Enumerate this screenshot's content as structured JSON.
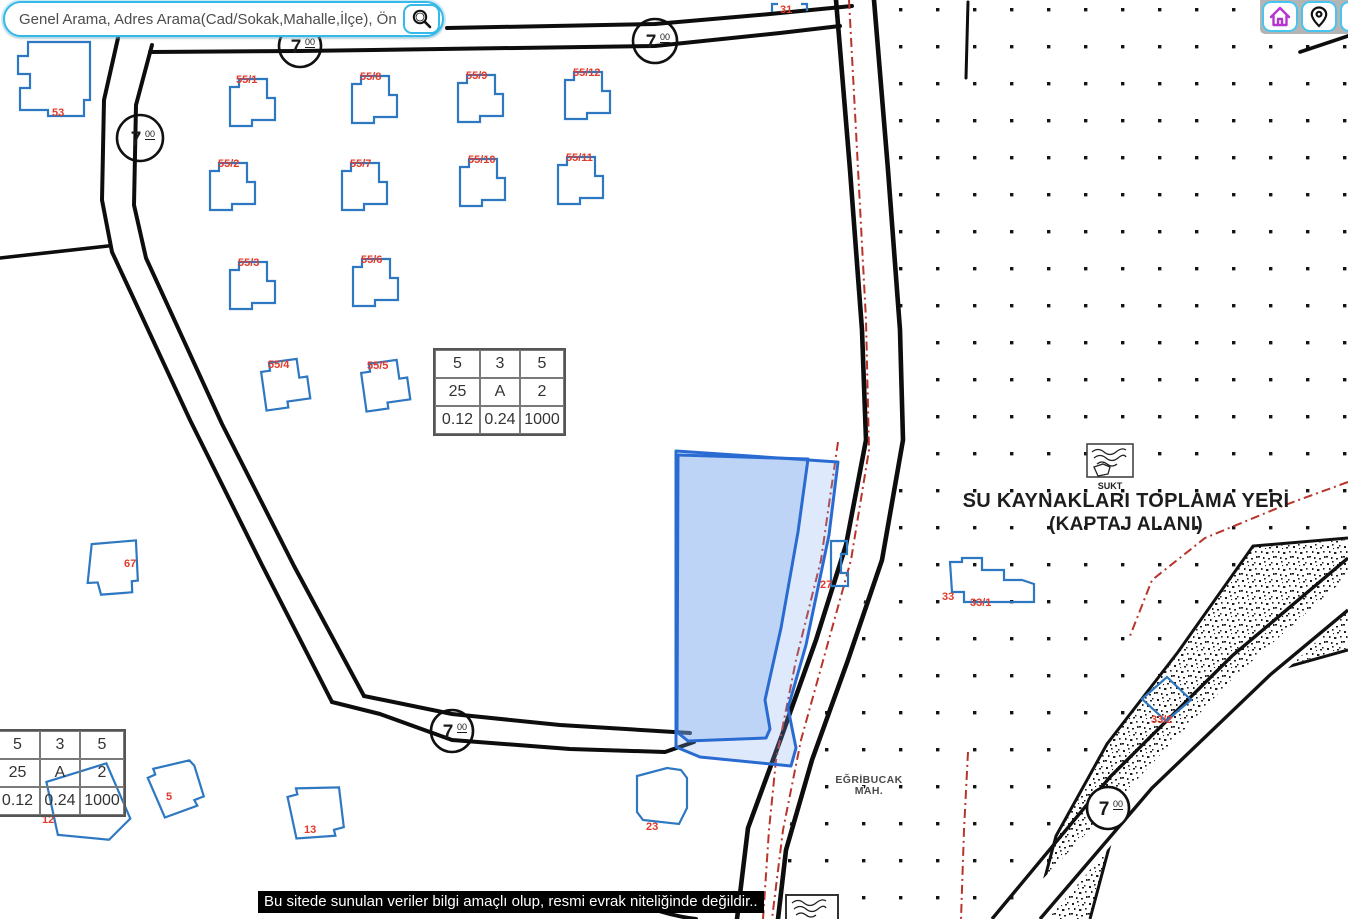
{
  "search": {
    "placeholder": "Genel Arama, Adres Arama(Cad/Sokak,Mahalle,İlçe), Önemli Yer Aram"
  },
  "toolbar": {
    "icons": [
      {
        "name": "home"
      },
      {
        "name": "location-pin"
      },
      {
        "name": "cut-off-right"
      }
    ]
  },
  "map": {
    "road_width_marker": {
      "value": "7",
      "sup": "00"
    },
    "parcels": [
      "53",
      "55/1",
      "55/8",
      "55/9",
      "55/12",
      "55/2",
      "55/7",
      "55/10",
      "55/11",
      "55/3",
      "55/6",
      "55/4",
      "55/5",
      "67",
      "5",
      "12",
      "13",
      "23",
      "31",
      "27",
      "33",
      "33/1",
      "33/2"
    ],
    "info_table": {
      "rows": [
        [
          "5",
          "3",
          "5"
        ],
        [
          "25",
          "A",
          "2"
        ],
        [
          "0.12",
          "0.24",
          "1000"
        ]
      ]
    },
    "water_area": {
      "line1": "SU KAYNAKLARI TOPLAMA YERİ",
      "line2": "(KAPTAJ ALANI)",
      "station_label": "SUKT"
    },
    "district": {
      "line1": "EĞRİBUCAK",
      "line2": "MAH."
    },
    "disclaimer": "Bu sitede sunulan veriler bilgi amaçlı olup, resmi evrak niteliğinde değildir.."
  }
}
